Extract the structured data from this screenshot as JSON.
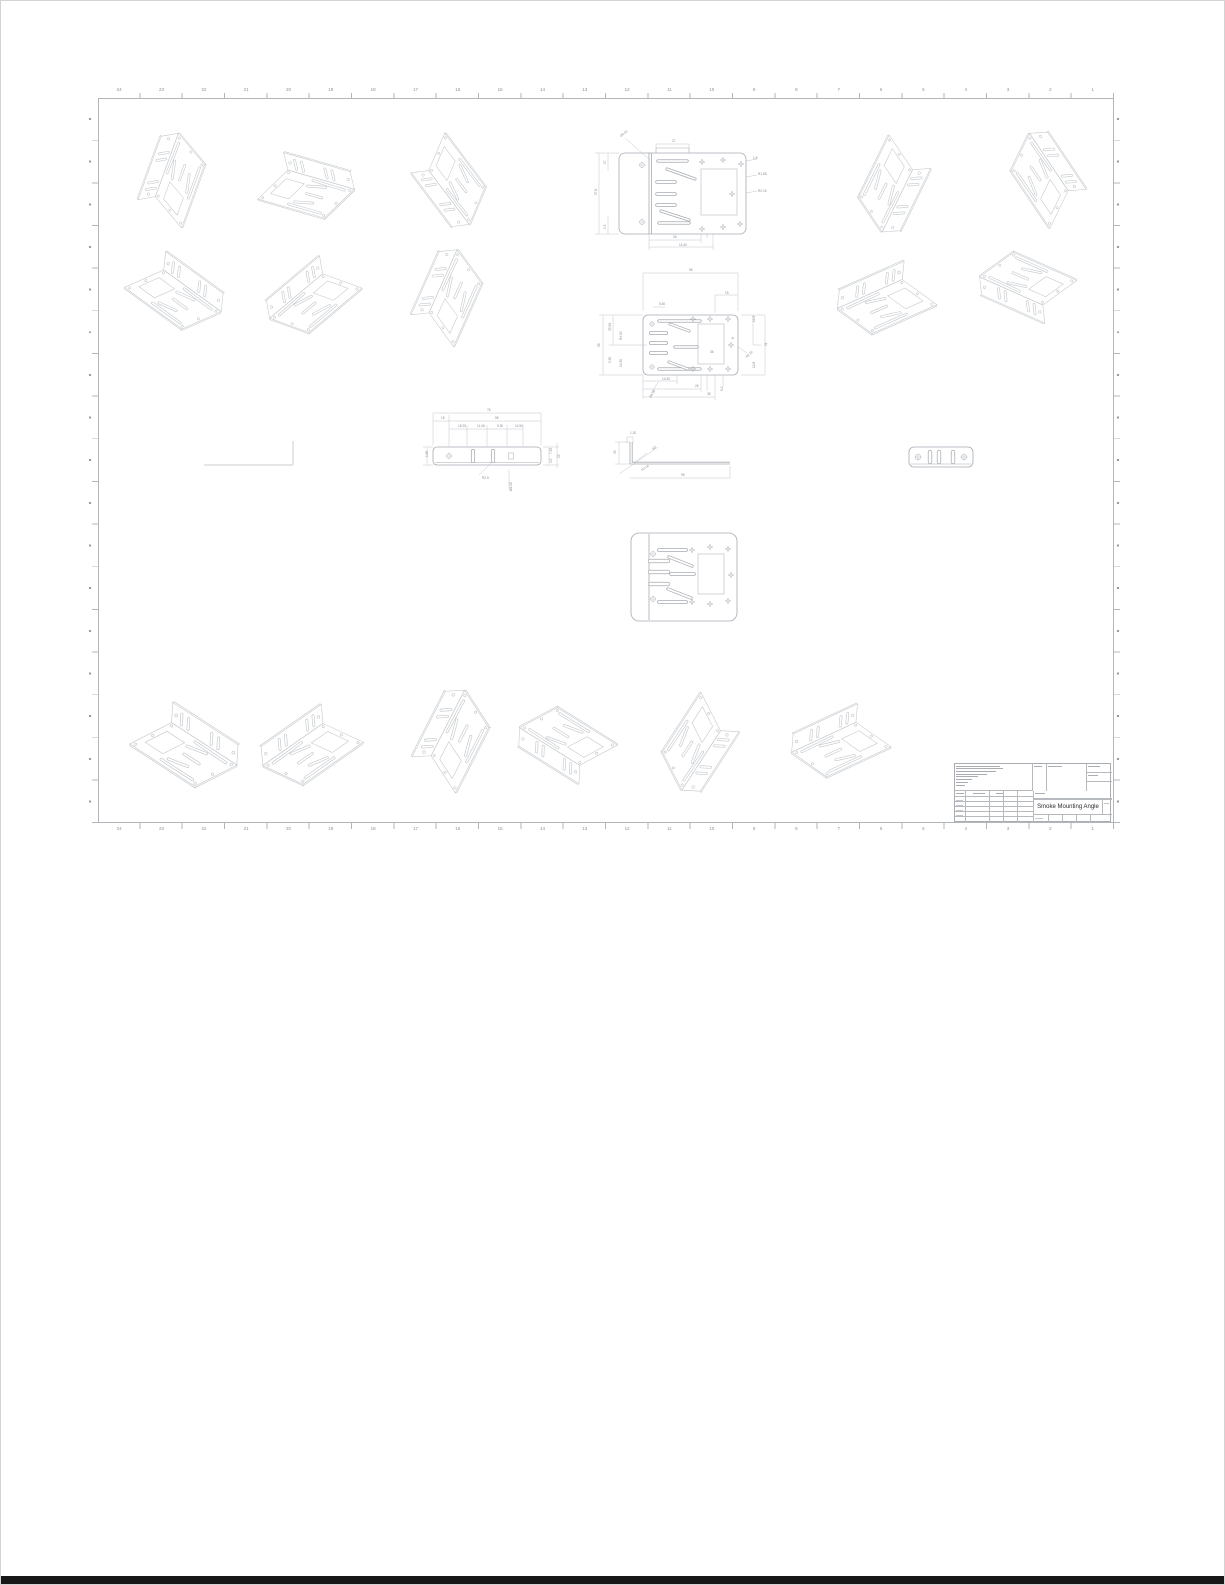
{
  "title_block": {
    "title": "Smoke Mounting Angle"
  },
  "border": {
    "zones_top": [
      "24",
      "23",
      "22",
      "21",
      "20",
      "19",
      "18",
      "17",
      "16",
      "15",
      "14",
      "13",
      "12",
      "11",
      "10",
      "9",
      "8",
      "7",
      "6",
      "5",
      "4",
      "3",
      "2",
      "1"
    ],
    "zones_bottom": [
      "24",
      "23",
      "22",
      "21",
      "20",
      "19",
      "18",
      "17",
      "16",
      "15",
      "14",
      "13",
      "12",
      "11",
      "10",
      "9",
      "8",
      "7",
      "6",
      "5",
      "4",
      "3",
      "2",
      "1"
    ]
  },
  "dims": {
    "top_view": [
      "Ø4.50",
      "27",
      "57.8",
      "17",
      "1.5",
      "1.8",
      "R1.85",
      "R2.16",
      "26",
      "7",
      "14.30"
    ],
    "main_view": [
      "96",
      "15",
      "5.50",
      "58",
      "25.58",
      "R4.50",
      "9.50",
      "14.30",
      "12.8",
      "51",
      "12.8",
      "R2.16",
      "14.30",
      "26",
      "36",
      "6.2",
      "Ø4.50",
      "36",
      "8"
    ],
    "strip_view": [
      "76",
      "15",
      "58",
      "15.25",
      "11.06",
      "9.30",
      "14.50",
      "7.25",
      "25",
      "4.5",
      "1.50",
      "R2.5",
      "Ø4.50"
    ],
    "profile_view": [
      "1.20",
      "25",
      "90°",
      "R2.16",
      "96"
    ]
  }
}
